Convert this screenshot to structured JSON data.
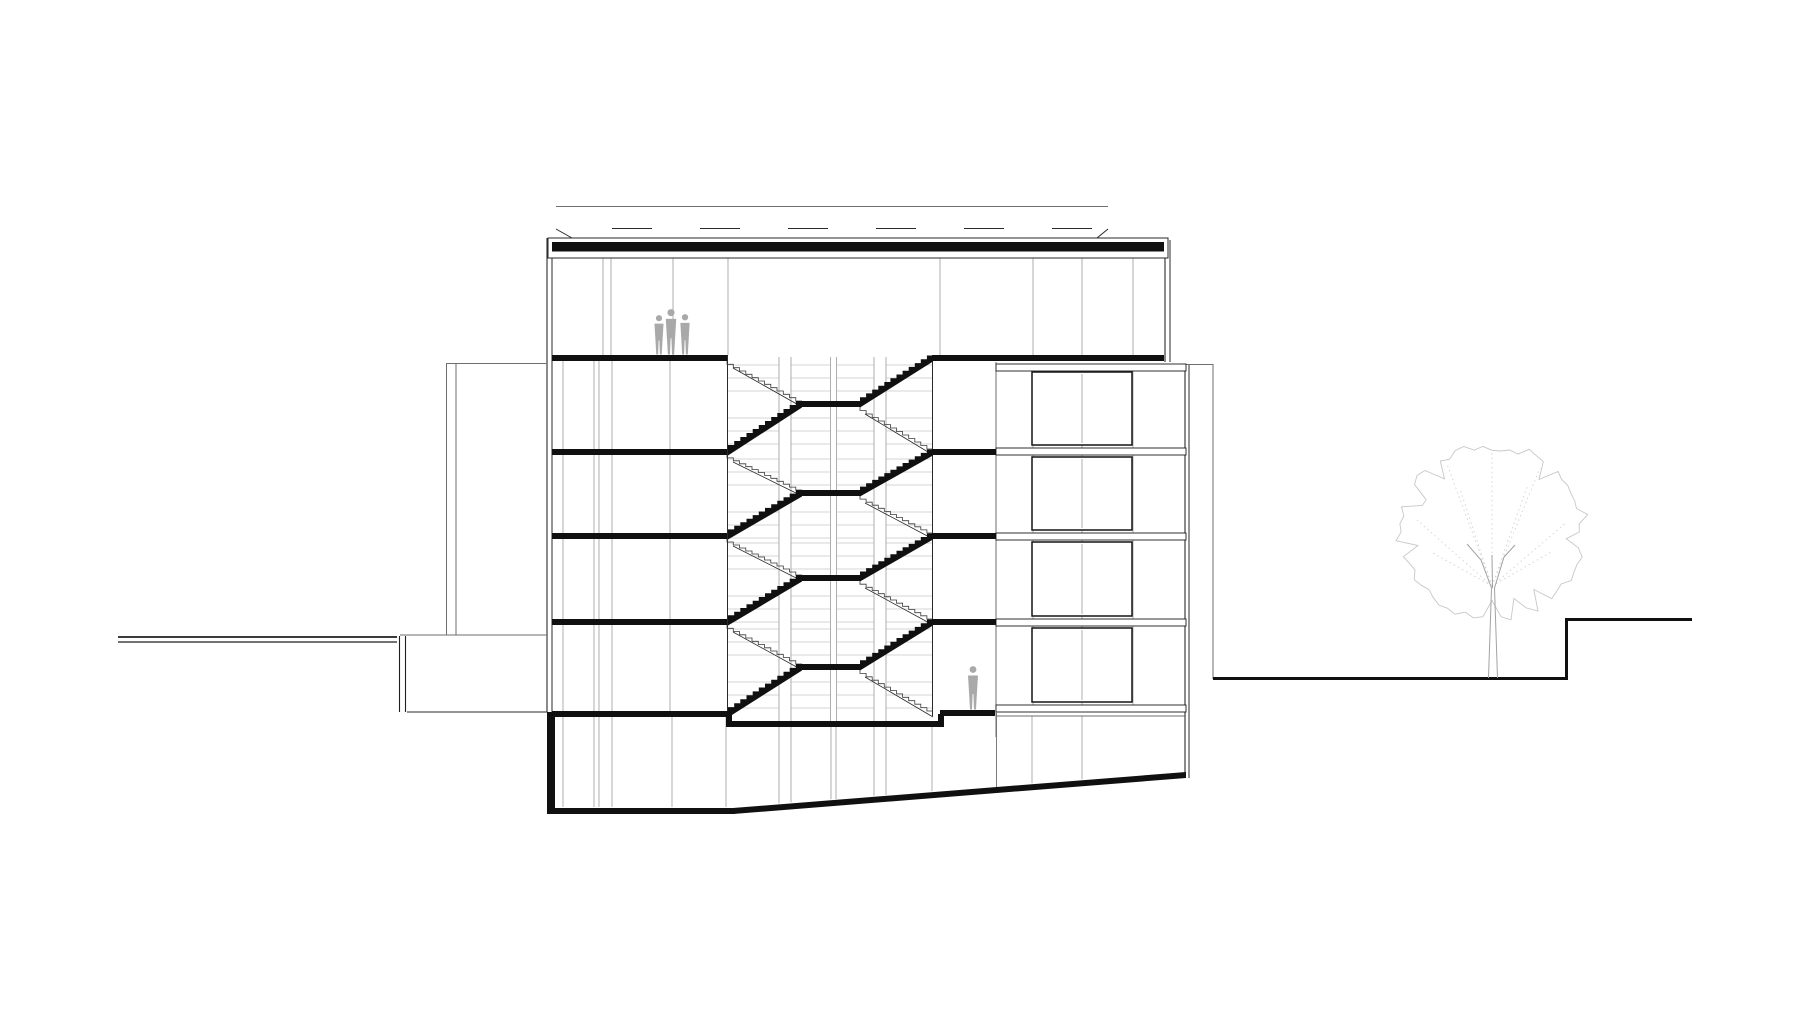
{
  "meta": {
    "title": "building-cross-section-architectural-drawing"
  },
  "drawing": {
    "canvas": {
      "w": 1800,
      "h": 1016
    },
    "colors": {
      "ink": "#1f1f1f",
      "black": "#101010",
      "wall": "#2a2a2a",
      "grid": "#a6a6a6",
      "lightgrid": "#c6c6c6",
      "mid": "#6e6e6e",
      "figure": "#a9a9a9",
      "tree": "#c7c7c7",
      "treedot": "#d2d2d2",
      "trunk": "#a2a2a2",
      "white": "#ffffff"
    },
    "roof": {
      "outline": {
        "x": 548,
        "y": 238,
        "w": 620,
        "h": 20
      },
      "slab": {
        "x": 552,
        "y": 242,
        "w": 612,
        "h": 9.5
      },
      "top_line": {
        "x1": 556,
        "y": 206.5,
        "x2": 1108
      },
      "canopy_dash": {
        "x1": 612,
        "y": 228.5,
        "x2": 1108,
        "dash": "40 48"
      },
      "diag_left": {
        "x1": 556,
        "y1": 229,
        "x2": 572,
        "y2": 238
      },
      "diag_right": {
        "x1": 1097,
        "y1": 238,
        "x2": 1108,
        "y2": 229
      }
    },
    "lines": [
      {
        "name": "wall-left-outer",
        "x1": 547,
        "y1": 238,
        "x2": 547,
        "y2": 712,
        "w": 1.1,
        "c": "wall"
      },
      {
        "name": "wall-left-inner",
        "x1": 552,
        "y1": 240,
        "x2": 552,
        "y2": 712,
        "w": 1,
        "c": "wall"
      },
      {
        "name": "wall-right-upper-outer",
        "x1": 1165,
        "y1": 240,
        "x2": 1165,
        "y2": 362,
        "w": 1.1,
        "c": "wall"
      },
      {
        "name": "wall-right-upper-inner",
        "x1": 1170,
        "y1": 240,
        "x2": 1170,
        "y2": 362,
        "w": 1,
        "c": "wall"
      },
      {
        "name": "stairwell-wall-left",
        "x1": 727.5,
        "y1": 355,
        "x2": 727.5,
        "y2": 721,
        "w": 1,
        "c": "wall"
      },
      {
        "name": "stairwell-wall-right",
        "x1": 932.5,
        "y1": 355,
        "x2": 932.5,
        "y2": 716,
        "w": 1,
        "c": "wall"
      },
      {
        "name": "wing-inner-wall",
        "x1": 996,
        "y1": 362,
        "x2": 996,
        "y2": 737,
        "w": 1,
        "c": "mid"
      },
      {
        "name": "wing-outer-wall-a",
        "x1": 1185,
        "y1": 364,
        "x2": 1185,
        "y2": 778,
        "w": 1.1,
        "c": "wall"
      },
      {
        "name": "wing-outer-wall-b",
        "x1": 1189,
        "y1": 364,
        "x2": 1189,
        "y2": 778,
        "w": 1,
        "c": "wall"
      },
      {
        "name": "bridge-top-line",
        "x1": 446,
        "y1": 363.5,
        "x2": 547,
        "y2": 363.5,
        "w": 1,
        "c": "mid"
      },
      {
        "name": "bridge-bottom-line",
        "x1": 400,
        "y1": 635,
        "x2": 547,
        "y2": 635,
        "w": 0.9,
        "c": "mid"
      },
      {
        "name": "screen-wall-left",
        "x1": 446.5,
        "y1": 363,
        "x2": 446.5,
        "y2": 635,
        "w": 1,
        "c": "mid"
      },
      {
        "name": "screen-wall-right",
        "x1": 456,
        "y1": 363,
        "x2": 456,
        "y2": 635,
        "w": 1,
        "c": "mid"
      },
      {
        "name": "terrace-line-a",
        "x1": 118,
        "y1": 637,
        "x2": 397,
        "y2": 637,
        "w": 1.8,
        "c": "ink"
      },
      {
        "name": "terrace-line-b",
        "x1": 118,
        "y1": 642,
        "x2": 397,
        "y2": 642,
        "w": 1.2,
        "c": "ink"
      },
      {
        "name": "terrace-post-a",
        "x1": 399.5,
        "y1": 636,
        "x2": 399.5,
        "y2": 712,
        "w": 1.1,
        "c": "ink"
      },
      {
        "name": "terrace-post-b",
        "x1": 405.5,
        "y1": 636,
        "x2": 405.5,
        "y2": 712,
        "w": 1.1,
        "c": "ink"
      },
      {
        "name": "ground-line-left-inner",
        "x1": 407,
        "y1": 712,
        "x2": 547,
        "y2": 712,
        "w": 1,
        "c": "wall"
      },
      {
        "name": "site-right-top-line",
        "x1": 1186,
        "y1": 364.5,
        "x2": 1213,
        "y2": 364.5,
        "w": 0.9,
        "c": "mid"
      },
      {
        "name": "site-right-wall-line",
        "x1": 1213,
        "y1": 364,
        "x2": 1213,
        "y2": 679,
        "w": 1,
        "c": "mid"
      },
      {
        "name": "wing-basement-top-line",
        "x1": 996,
        "y1": 716,
        "x2": 1186,
        "y2": 716,
        "w": 0.9,
        "c": "mid"
      }
    ],
    "ground_right": [
      {
        "name": "ground-lower",
        "x1": 1213,
        "y1": 678.5,
        "x2": 1567,
        "y2": 678.5,
        "w": 3
      },
      {
        "name": "ground-step",
        "x1": 1566.5,
        "y1": 680,
        "x2": 1566.5,
        "y2": 618.5,
        "w": 3
      },
      {
        "name": "ground-upper",
        "x1": 1565,
        "y1": 619.5,
        "x2": 1692,
        "y2": 619.5,
        "w": 3
      }
    ],
    "mullions": [
      {
        "name": "top-floor",
        "xs": [
          603,
          611,
          673,
          728,
          940,
          1033,
          1082,
          1133
        ],
        "y1": 258,
        "y2": 355
      },
      {
        "name": "left-rooms",
        "xs": [
          563,
          594,
          599,
          612,
          670
        ],
        "y1": 361,
        "y2": 711
      },
      {
        "name": "wing-back",
        "xs": [
          1033,
          1082,
          1133
        ],
        "y1": 371,
        "y2": 705
      },
      {
        "name": "basement-left",
        "xs": [
          563,
          594,
          599,
          612,
          672,
          726
        ],
        "y1": 717,
        "y2": 807
      }
    ],
    "basement_cols": {
      "xs": [
        779,
        791,
        831,
        836,
        874,
        886,
        932,
        1032,
        1082
      ],
      "y1": 727,
      "y1_right": 716
    },
    "stairwell": {
      "left": 727,
      "right": 933,
      "floors_top": [
        355,
        449,
        533,
        619
      ],
      "floors_bottom": [
        449,
        533,
        619,
        711
      ],
      "landing": {
        "x": 802,
        "w": 58,
        "t": 6
      },
      "grid_x1": 728,
      "grid_x2": 932,
      "grid_offsets": [
        4,
        17,
        30,
        57,
        70,
        83
      ],
      "columns": [
        {
          "x": 779,
          "w": 12
        },
        {
          "x": 830.5,
          "w": 6
        },
        {
          "x": 874,
          "w": 12
        }
      ],
      "col_y1": 357,
      "col_y2": 721,
      "steps": 12,
      "thickness": 6.5
    },
    "slabs": [
      {
        "name": "slab1-left",
        "x": 552,
        "y": 355,
        "w": 175,
        "h": 6
      },
      {
        "name": "slab1-right",
        "x": 932,
        "y": 355,
        "w": 232,
        "h": 6
      },
      {
        "name": "slab2-left",
        "x": 552,
        "y": 449,
        "w": 175,
        "h": 6
      },
      {
        "name": "slab2-right",
        "x": 932,
        "y": 449,
        "w": 64,
        "h": 6
      },
      {
        "name": "slab3-left",
        "x": 552,
        "y": 533,
        "w": 175,
        "h": 6
      },
      {
        "name": "slab3-right",
        "x": 932,
        "y": 533,
        "w": 64,
        "h": 6
      },
      {
        "name": "slab4-left",
        "x": 552,
        "y": 619,
        "w": 175,
        "h": 6
      },
      {
        "name": "slab4-right",
        "x": 932,
        "y": 619,
        "w": 64,
        "h": 6
      },
      {
        "name": "slab5-left",
        "x": 552,
        "y": 711,
        "w": 180,
        "h": 6
      },
      {
        "name": "pit-step-left",
        "x": 726,
        "y": 711,
        "w": 6,
        "h": 16
      },
      {
        "name": "pit-floor",
        "x": 726,
        "y": 721,
        "w": 218,
        "h": 6
      },
      {
        "name": "pit-step-right",
        "x": 938,
        "y": 714,
        "w": 6,
        "h": 13
      },
      {
        "name": "landing-ground",
        "x": 940,
        "y": 710,
        "w": 55,
        "h": 6
      },
      {
        "name": "basement-wall-left",
        "x": 547,
        "y": 712,
        "w": 8,
        "h": 102
      },
      {
        "name": "basement-floor",
        "x": 547,
        "y": 808,
        "w": 188,
        "h": 6
      }
    ],
    "ramp": {
      "x1": 733,
      "y1": 808,
      "x2": 1186,
      "y2": 772,
      "t": 6
    },
    "wing": {
      "bands": [
        {
          "name": "wing-band-roof",
          "x": 996,
          "y": 364,
          "w": 190,
          "h": 7
        },
        {
          "name": "wing-band-2",
          "x": 996,
          "y": 448,
          "w": 190,
          "h": 7
        },
        {
          "name": "wing-band-3",
          "x": 996,
          "y": 533,
          "w": 190,
          "h": 7
        },
        {
          "name": "wing-band-4",
          "x": 996,
          "y": 619,
          "w": 190,
          "h": 7
        },
        {
          "name": "wing-band-5",
          "x": 996,
          "y": 705,
          "w": 190,
          "h": 7
        }
      ],
      "boxes": [
        {
          "name": "window-box-1",
          "x": 1032,
          "y": 372,
          "w": 100,
          "h": 73
        },
        {
          "name": "window-box-2",
          "x": 1032,
          "y": 457,
          "w": 100,
          "h": 73
        },
        {
          "name": "window-box-3",
          "x": 1032,
          "y": 542,
          "w": 100,
          "h": 74
        },
        {
          "name": "window-box-4",
          "x": 1032,
          "y": 628,
          "w": 100,
          "h": 74
        }
      ],
      "box_divider_x": 1082,
      "basement_left_line": {
        "x": 996.5,
        "y1": 712,
        "y2": 787
      }
    },
    "figures": [
      {
        "name": "figure-person-1",
        "x": 659,
        "base": 355,
        "h": 40
      },
      {
        "name": "figure-person-2",
        "x": 671,
        "base": 355,
        "h": 46
      },
      {
        "name": "figure-person-3",
        "x": 685,
        "base": 355,
        "h": 41
      },
      {
        "name": "figure-person-4",
        "x": 973,
        "base": 710,
        "h": 44
      }
    ],
    "tree": {
      "cx": 1492,
      "cy": 532,
      "rx": 97,
      "ry": 89,
      "points": 64,
      "trunk_paths": [
        "M1488.5 678 C1489.5 645 1490.5 612 1491.5 588",
        "M1497.5 678 C1496.5 645 1495.5 612 1494.5 588",
        "M1491.5 588 L1481 560 L1467 544",
        "M1494.5 588 L1504 557 L1515 545",
        "M1492.5 588 L1492 555"
      ],
      "branch_origin": {
        "x": 1492,
        "y": 586
      },
      "branch_tips": [
        [
          1492,
          452
        ],
        [
          1447,
          464
        ],
        [
          1540,
          468
        ],
        [
          1417,
          520
        ],
        [
          1567,
          522
        ],
        [
          1460,
          489
        ],
        [
          1527,
          487
        ],
        [
          1433,
          553
        ],
        [
          1553,
          551
        ]
      ]
    }
  }
}
